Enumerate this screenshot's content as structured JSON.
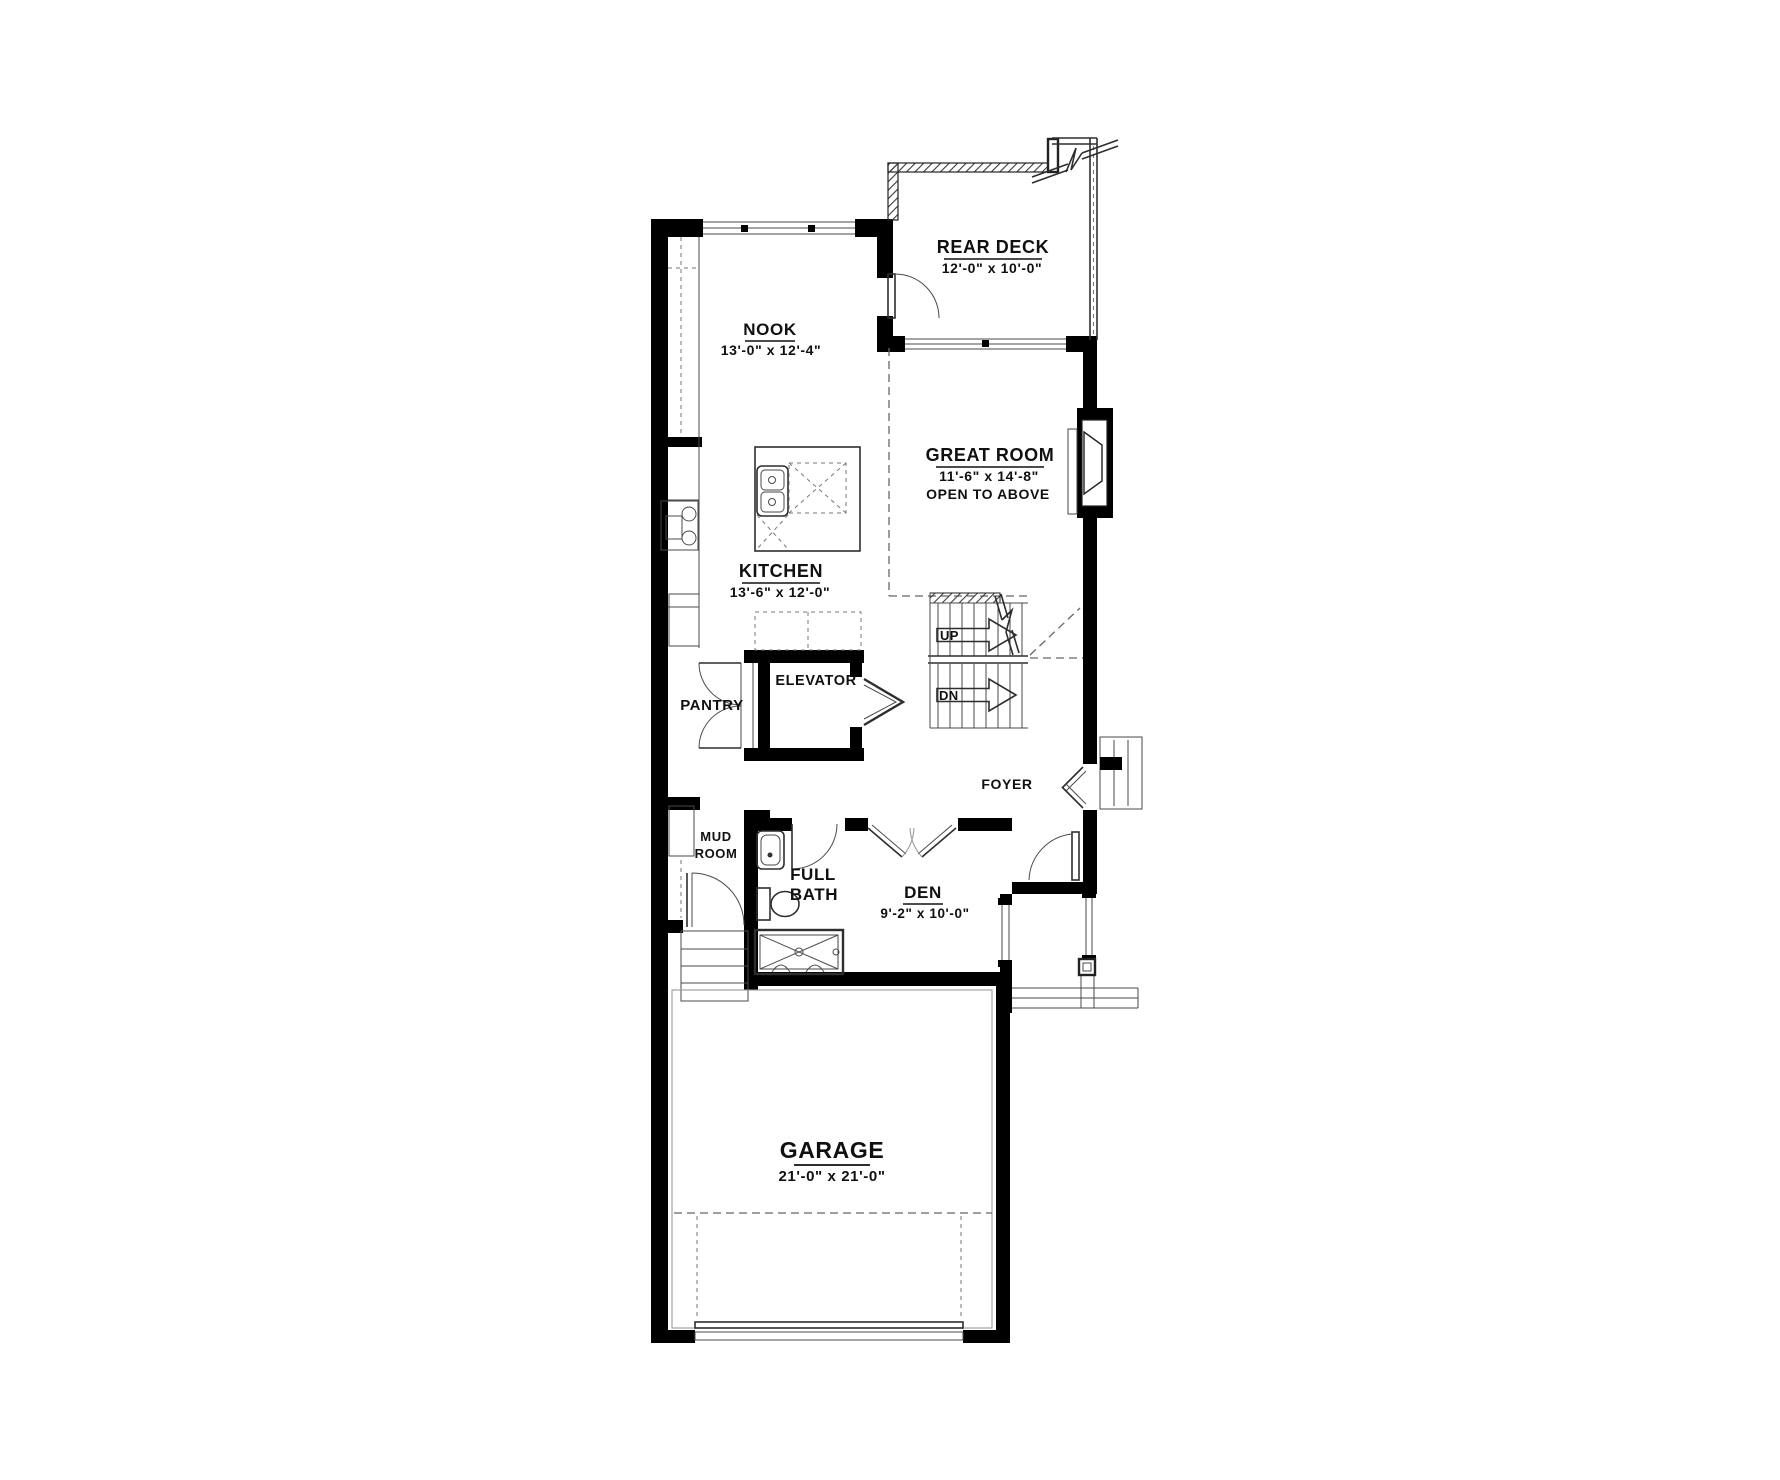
{
  "plan": {
    "type": "main-floor-plan",
    "colors": {
      "wall": "#000000",
      "line": "#2e2e2e",
      "dashed": "#666666"
    },
    "rooms": {
      "rear_deck": {
        "name": "REAR DECK",
        "dims": "12'-0\" x 10'-0\""
      },
      "nook": {
        "name": "NOOK",
        "dims": "13'-0\" x 12'-4\""
      },
      "great_room": {
        "name": "GREAT ROOM",
        "dims": "11'-6\" x 14'-8\"",
        "note": "OPEN TO ABOVE"
      },
      "kitchen": {
        "name": "KITCHEN",
        "dims": "13'-6\" x 12'-0\""
      },
      "elevator": {
        "name": "ELEVATOR"
      },
      "pantry": {
        "name": "PANTRY"
      },
      "foyer": {
        "name": "FOYER"
      },
      "mud_room": {
        "line1": "MUD",
        "line2": "ROOM"
      },
      "full_bath": {
        "line1": "FULL",
        "line2": "BATH"
      },
      "den": {
        "name": "DEN",
        "dims": "9'-2\" x 10'-0\""
      },
      "garage": {
        "name": "GARAGE",
        "dims": "21'-0\" x 21'-0\""
      }
    },
    "stairs": {
      "up_label": "UP",
      "dn_label": "DN"
    }
  }
}
